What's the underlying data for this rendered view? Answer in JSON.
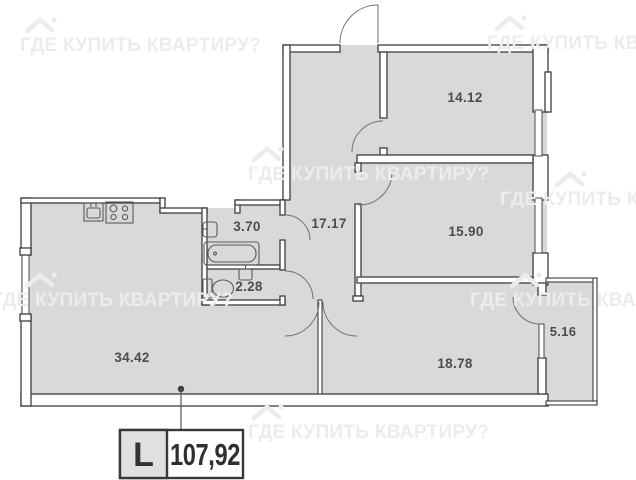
{
  "floorplan": {
    "rooms": [
      {
        "name": "bedroom-1",
        "area": "14.12"
      },
      {
        "name": "bedroom-2",
        "area": "15.90"
      },
      {
        "name": "hallway",
        "area": "17.17"
      },
      {
        "name": "bathroom",
        "area": "3.70"
      },
      {
        "name": "wc",
        "area": "2.28"
      },
      {
        "name": "living-kitchen",
        "area": "34.42"
      },
      {
        "name": "bedroom-3",
        "area": "18.78"
      },
      {
        "name": "balcony",
        "area": "5.16"
      }
    ],
    "total": {
      "type_letter": "L",
      "total_area": "107,92"
    },
    "watermark": {
      "text": "ГДЕ КУПИТЬ КВАРТИРУ?"
    },
    "colors": {
      "floor_fill": "#d9d9d9",
      "wall_line": "#3d3d3d",
      "label_text": "#4c4c4c",
      "watermark": "#ececec"
    }
  }
}
